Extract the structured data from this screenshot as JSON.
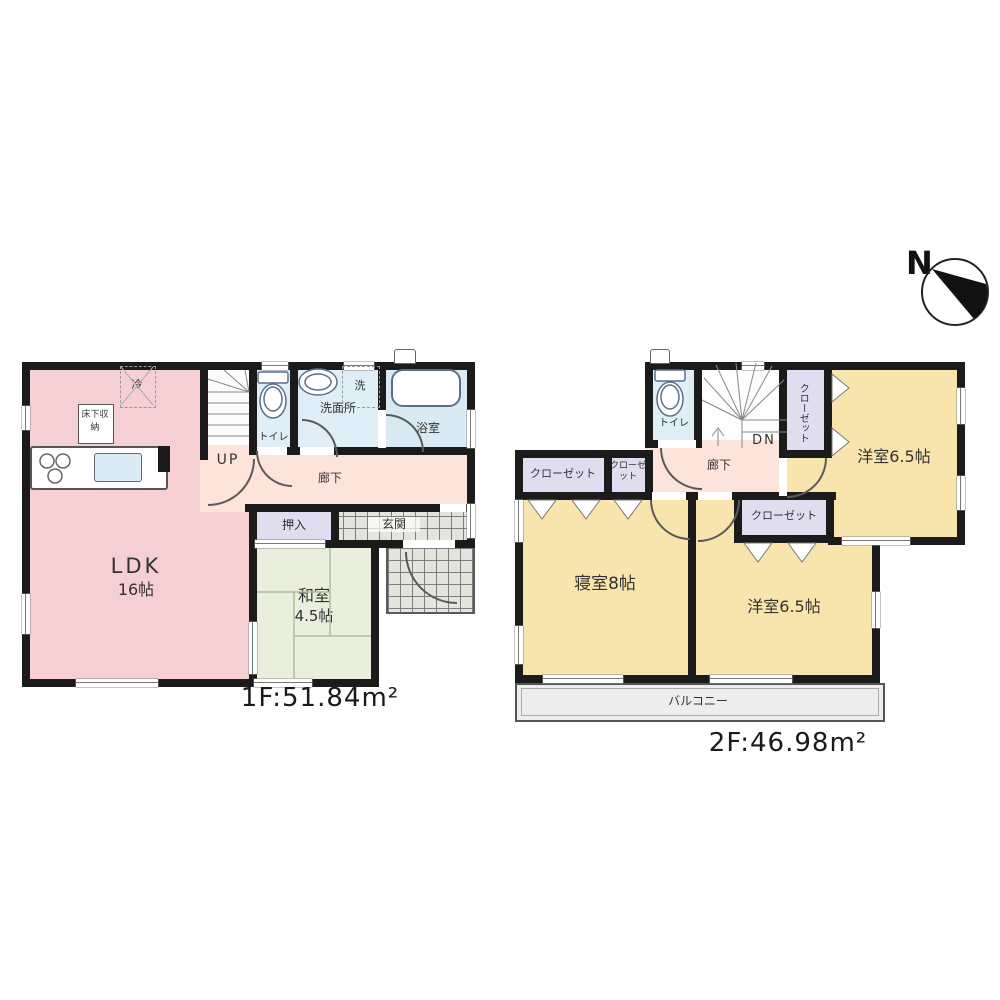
{
  "compass": {
    "label": "N"
  },
  "floor1": {
    "area_label": "1F:51.84m²",
    "labels": {
      "ldk": "LDK",
      "ldk_size": "16帖",
      "washitsu": "和室",
      "washitsu_size": "4.5帖",
      "oshiire": "押入",
      "genkan": "玄関",
      "hallway": "廊下",
      "toilet": "トイレ",
      "washroom": "洗面所",
      "laundry": "洗",
      "bath": "浴室",
      "stairs": "UP",
      "fridge": "冷",
      "floor_storage": "床下収納"
    }
  },
  "floor2": {
    "area_label": "2F:46.98m²",
    "labels": {
      "bedroom": "寝室8帖",
      "western_a": "洋室6.5帖",
      "western_b": "洋室6.5帖",
      "closet_wide": "クローゼット",
      "closet_small": "クローゼット",
      "closet_mid": "クローゼット",
      "closet_vertical": "クローゼット",
      "toilet": "トイレ",
      "hallway": "廊下",
      "stairs": "DN",
      "balcony": "バルコニー"
    }
  },
  "colors": {
    "wall": "#1b1b1b",
    "ldk_pink": "#f6cfd3",
    "hallway_peach": "#fce4da",
    "sanitary_blue": "#dfeef7",
    "closet_lavender": "#e1ddf0",
    "tatami_green": "#e9efdc",
    "room_yellow": "#f8e5ae",
    "balcony_gray": "#ededed"
  }
}
